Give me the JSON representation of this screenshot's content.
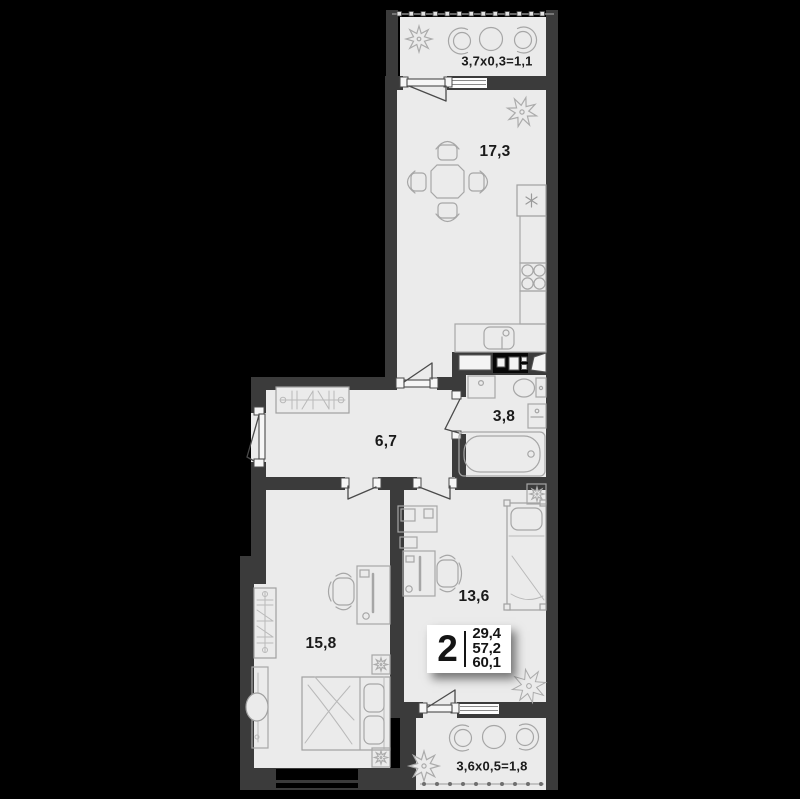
{
  "plan": {
    "title": "2-room apartment floor plan",
    "colors": {
      "background": "#000000",
      "wall": "#3b3b3b",
      "floor": "#ebebeb",
      "line": "#a6a6a6",
      "text": "#1a1a1a",
      "badge": "#ffffff"
    },
    "rooms": [
      {
        "id": "balcony-top",
        "label": "3,7x0,3=1,1"
      },
      {
        "id": "kitchen-living",
        "label": "17,3"
      },
      {
        "id": "bathroom",
        "label": "3,8"
      },
      {
        "id": "hallway",
        "label": "6,7"
      },
      {
        "id": "bedroom-right",
        "label": "13,6"
      },
      {
        "id": "bedroom-left",
        "label": "15,8"
      },
      {
        "id": "balcony-bottom",
        "label": "3,6x0,5=1,8"
      }
    ],
    "stats_badge": {
      "rooms": "2",
      "values": [
        "29,4",
        "57,2",
        "60,1"
      ]
    },
    "furniture_icons": [
      "dining-table",
      "chair",
      "fridge",
      "stove",
      "kitchen-sink",
      "wardrobe",
      "dresser-mirror",
      "double-bed",
      "single-bed",
      "nightstand",
      "desk",
      "office-chair",
      "bathtub",
      "toilet",
      "washing-machine",
      "bath-sink",
      "tub-chair",
      "round-table",
      "plant",
      "vent-shaft",
      "railing"
    ]
  }
}
